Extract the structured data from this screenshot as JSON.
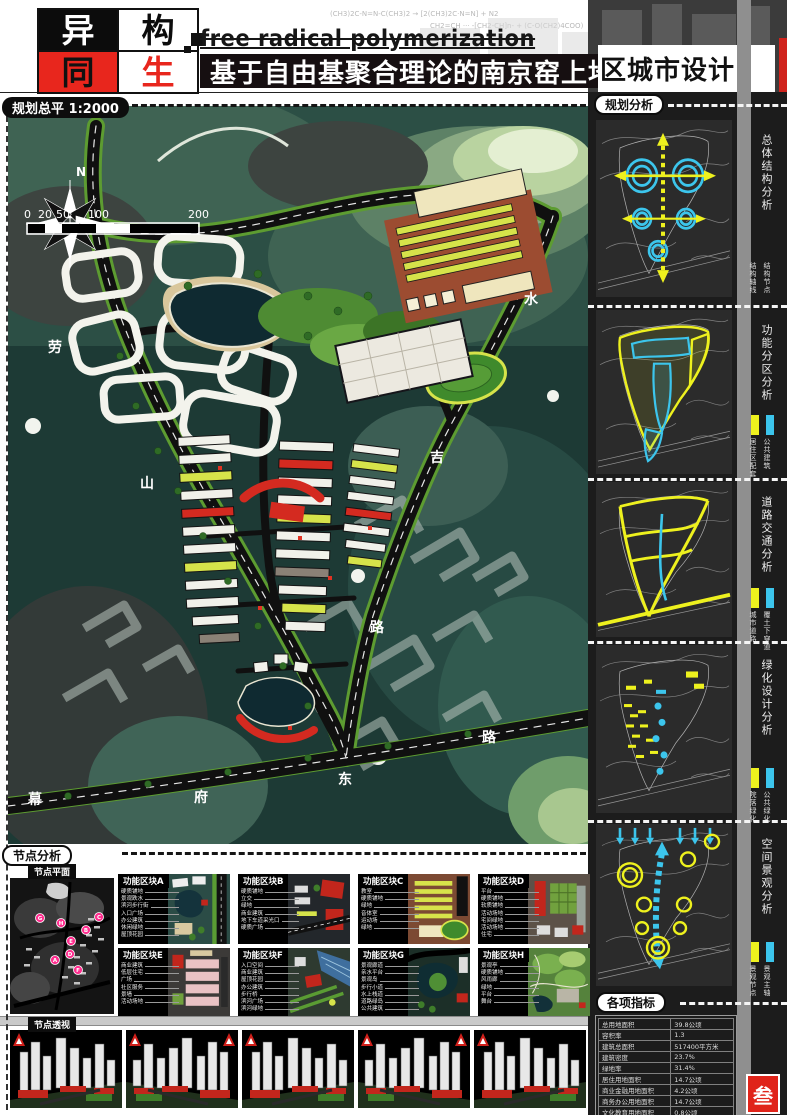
{
  "header": {
    "logo": [
      "异",
      "构",
      "同",
      "生"
    ],
    "title_en": "free radical polymerization",
    "title_zh_left": "基于自由基聚合理论的南京窑上地",
    "title_zh_right": "区城市设计",
    "chem_line1": "(CH3)2C-N=N-C(CH3)2 → [2(CH3)2C·N=N] + N2",
    "chem_line2": "CH2=CH ··· -[CH2-CH]n-  + (C-O(CH2)4COO)"
  },
  "map": {
    "label": "规划总平 1:2000",
    "north": "N",
    "scale_ticks": [
      "0",
      "20",
      "50",
      "100",
      "200"
    ],
    "road_labels": [
      {
        "t": "劳"
      },
      {
        "t": "山"
      },
      {
        "t": "水"
      },
      {
        "t": "吉"
      },
      {
        "t": "路"
      },
      {
        "t": "幕"
      },
      {
        "t": "府"
      },
      {
        "t": "东"
      },
      {
        "t": "路"
      }
    ]
  },
  "sidebar": {
    "header": "规划分析",
    "accent_yellow": "#eef11e",
    "accent_cyan": "#3cc5ec",
    "panels": [
      {
        "label": "总体结构分析",
        "legend": [
          {
            "color": "#eef11e",
            "text": "结构轴线"
          },
          {
            "color": "#3cc5ec",
            "text": "结构节点"
          }
        ]
      },
      {
        "label": "功能分区分析",
        "legend": [
          {
            "color": "#eef11e",
            "text": "居住区配套"
          },
          {
            "color": "#3cc5ec",
            "text": "公共建筑"
          }
        ]
      },
      {
        "label": "道路交通分析",
        "legend": [
          {
            "color": "#eef11e",
            "text": "城市道路"
          },
          {
            "color": "#3cc5ec",
            "text": "覆土下穿道"
          }
        ]
      },
      {
        "label": "绿化设计分析",
        "legend": [
          {
            "color": "#eef11e",
            "text": "院落绿化"
          },
          {
            "color": "#3cc5ec",
            "text": "公共绿化"
          }
        ]
      },
      {
        "label": "空间景观分析",
        "legend": [
          {
            "color": "#eef11e",
            "text": "景观节点"
          },
          {
            "color": "#3cc5ec",
            "text": "景观主轴"
          }
        ]
      }
    ],
    "indicators": {
      "header": "各项指标",
      "rows": [
        [
          "总用地面积",
          "39.8公顷"
        ],
        [
          "容积率",
          "1.3"
        ],
        [
          "建筑总面积",
          "517400平方米"
        ],
        [
          "建筑密度",
          "23.7%"
        ],
        [
          "绿地率",
          "31.4%"
        ],
        [
          "居住用地面积",
          "14.7公顷"
        ],
        [
          "商业金融用地面积",
          "4.2公顷"
        ],
        [
          "商务办公用地面积",
          "14.7公顷"
        ],
        [
          "文化教育用地面积",
          "0.8公顷"
        ],
        [
          "现状人口",
          "1400人"
        ],
        [
          "规划人口",
          "6600人"
        ],
        [
          "机动车位",
          "3030个"
        ]
      ]
    },
    "page_number": "叁"
  },
  "nodes": {
    "header": "节点分析",
    "plan_label": "节点平面",
    "perspective_label": "节点透视",
    "markers": [
      "A",
      "B",
      "C",
      "D",
      "E",
      "F",
      "G",
      "H"
    ],
    "blocks": [
      {
        "label": "功能区块A",
        "items": [
          "硬质铺地",
          "景观跌水",
          "滨河步行街",
          "入口广场",
          "办公建筑",
          "休闲绿地",
          "屋顶花园"
        ]
      },
      {
        "label": "功能区块B",
        "items": [
          "硬质铺地",
          "立交",
          "绿地",
          "商业建筑",
          "地下车道采光口",
          "硬质广场"
        ]
      },
      {
        "label": "功能区块C",
        "items": [
          "教室",
          "硬质铺地",
          "绿地",
          "音体室",
          "运动场",
          "绿地"
        ]
      },
      {
        "label": "功能区块D",
        "items": [
          "平台",
          "硬质铺地",
          "软质铺地",
          "活动场地",
          "宅间绿地",
          "活动场地",
          "住宅"
        ]
      },
      {
        "label": "功能区块E",
        "items": [
          "商业建筑",
          "低层住宅",
          "广场",
          "社区服务",
          "景墙",
          "活动场地"
        ]
      },
      {
        "label": "功能区块F",
        "items": [
          "入口空间",
          "商业建筑",
          "屋顶花园",
          "办公建筑",
          "步行桥",
          "滨河广场",
          "滨河绿地"
        ]
      },
      {
        "label": "功能区块G",
        "items": [
          "景观廊道",
          "亲水平台",
          "景观岛",
          "步行小道",
          "水上栈道",
          "道路绿岛",
          "公共建筑"
        ]
      },
      {
        "label": "功能区块H",
        "items": [
          "景观亭",
          "硬质铺地",
          "风雨廊",
          "绿地",
          "平台",
          "舞台"
        ]
      }
    ]
  }
}
